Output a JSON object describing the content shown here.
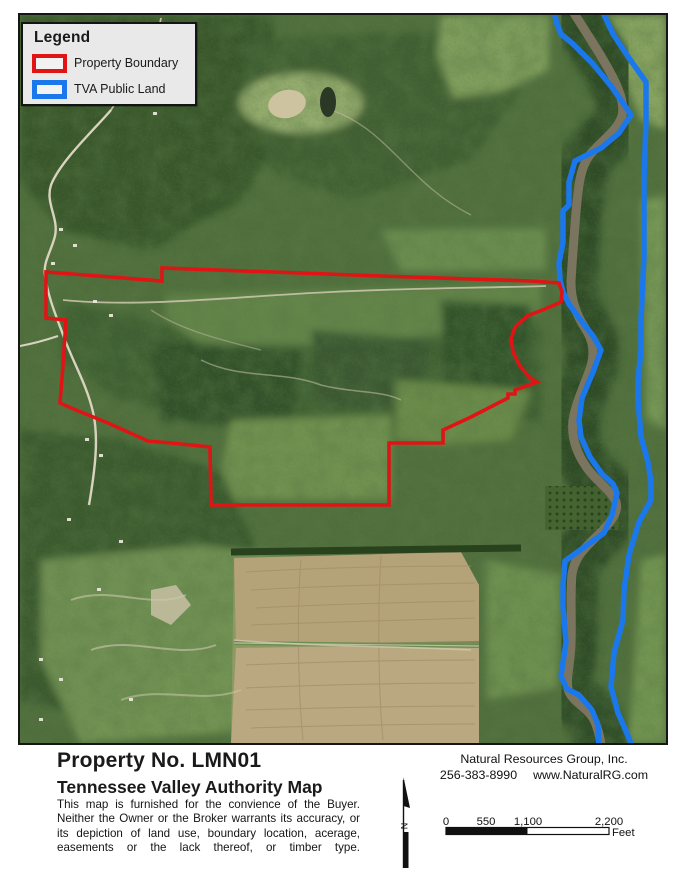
{
  "legend": {
    "title": "Legend",
    "items": [
      {
        "label": "Property Boundary"
      },
      {
        "label": "TVA Public Land"
      }
    ]
  },
  "colors": {
    "property_boundary": "#e01414",
    "tva_public_land": "#1a78ec",
    "river": "#7b755f",
    "legend_background": "#e9e9e9"
  },
  "footer": {
    "property_no": "Property No. LMN01",
    "map_title": "Tennessee Valley Authority Map",
    "disclaimer": "This map is furnished for the convience of the Buyer. Neither the Owner or the Broker warrants its accuracy, or its depiction of land use, boundary location, acerage, easements or the lack thereof, or timber type.",
    "company_name": "Natural Resources Group, Inc.",
    "phone": "256-383-8990",
    "website": "www.NaturalRG.com",
    "north_arrow_label": "N",
    "scale_bar": {
      "ticks": [
        "0",
        "550",
        "1,100",
        "2,200"
      ],
      "unit_label": "Feet"
    }
  }
}
